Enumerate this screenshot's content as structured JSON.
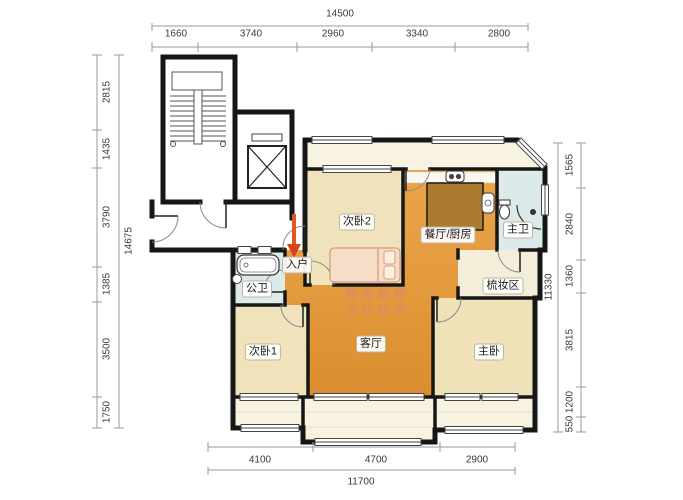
{
  "title": "residential floor plan",
  "watermark": {
    "line1": "楼房装修",
    "line2": "设计助手"
  },
  "rooms": {
    "bedroom2": "次卧2",
    "dining_kitchen": "餐厅/厨房",
    "master_bath": "主卫",
    "entry": "入户",
    "public_bath": "公卫",
    "dressing_area": "梳妆区",
    "bedroom1": "次卧1",
    "living_room": "客厅",
    "master_bedroom": "主卧"
  },
  "dimensions": {
    "top": {
      "total": "14500",
      "segments": [
        "1660",
        "3740",
        "2960",
        "3340",
        "2800"
      ]
    },
    "left": {
      "total": "14675",
      "segments": [
        "2815",
        "1435",
        "3790",
        "1385",
        "3500",
        "1750"
      ]
    },
    "right": {
      "total": "11330",
      "segments": [
        "1565",
        "2840",
        "1360",
        "3815",
        "1200",
        "550"
      ]
    },
    "bottom": {
      "total": "11700",
      "segments": [
        "4100",
        "4700",
        "2900"
      ]
    }
  },
  "colors": {
    "wall": "#161616",
    "orange_floor": "#e39a3c",
    "bedroom_floor": "#f0e3bb",
    "balcony_floor": "#f8f2e0",
    "bath_floor": "#dceaea",
    "entry_arrow": "#e2571e",
    "dimension_text": "#3a3a3a",
    "watermark_pink": "#e07a86"
  }
}
